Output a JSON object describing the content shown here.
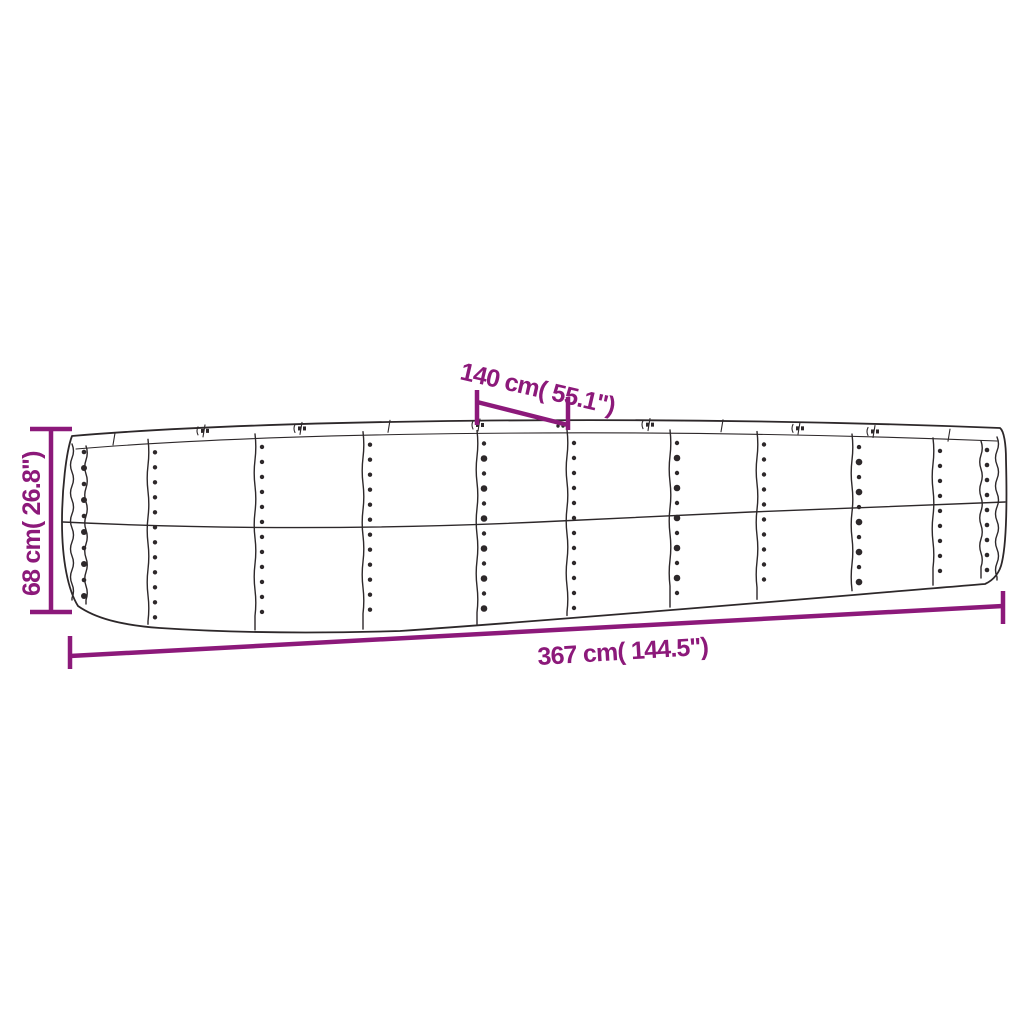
{
  "diagram": {
    "type": "product-dimension-diagram",
    "subject_icon": "raised-garden-bed-drawing",
    "background_color": "#ffffff",
    "drawing_line_color": "#2d282a",
    "dimension_color": "#8c197a",
    "dimensions": {
      "height": {
        "label": "68 cm( 26.8\")",
        "orientation": "vertical-left"
      },
      "end_width": {
        "label": "140 cm( 55.1\")",
        "orientation": "diagonal-top"
      },
      "length": {
        "label": "367 cm( 144.5\")",
        "orientation": "horizontal-bottom"
      }
    }
  }
}
